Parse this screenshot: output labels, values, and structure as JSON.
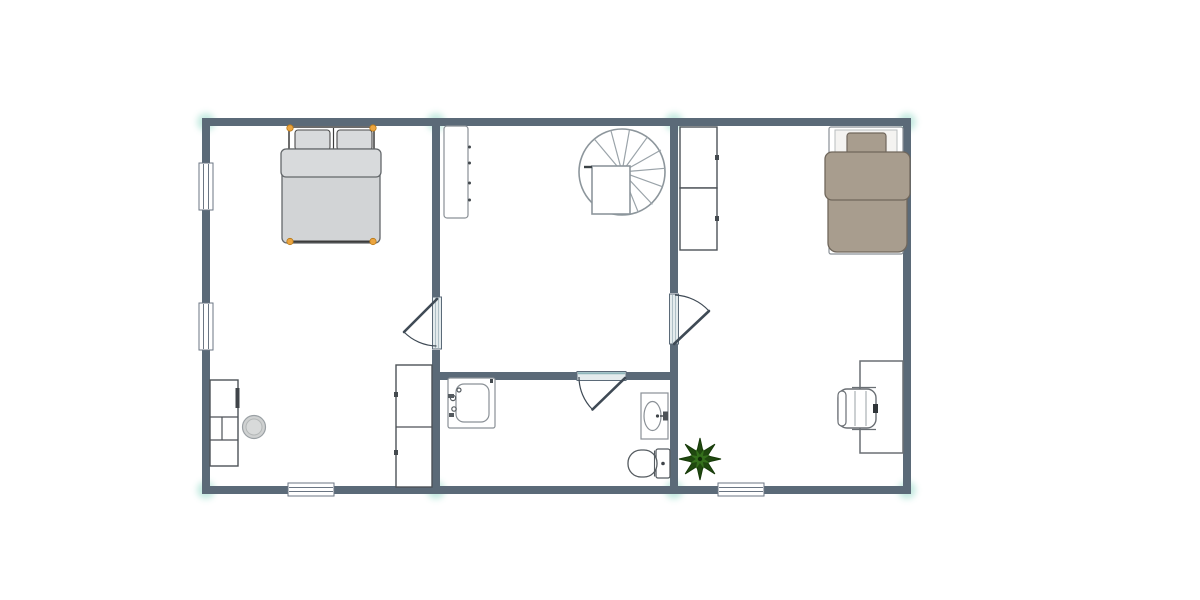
{
  "canvas": {
    "type": "floor-plan-editor-canvas",
    "background": "#ffffff",
    "plan_bounds_px": {
      "left": 202,
      "top": 118,
      "right": 911,
      "bottom": 494
    }
  },
  "colors": {
    "wall": "#5b6a78",
    "snap": "#7fd1bd",
    "outline": "#4d5257",
    "outlineLight": "#8a9096",
    "bedGray": "#d2d4d6",
    "bedGrayFold": "#d8dadc",
    "taupe": "#a89d8e",
    "taupeDark": "#70675c",
    "handle": "#eca53f",
    "handleStroke": "#b77818",
    "plantDark": "#20490f",
    "plantLight": "#35701c",
    "doorLeaf": "#e4ebed",
    "doorTeal": "#8fb6bb",
    "swing": "#3f4a55",
    "stoolFill": "#cfd1d1"
  },
  "floor_plan": {
    "wall_thickness_px": 8,
    "rooms": [
      {
        "name": "bedroom-left",
        "furniture": [
          "double-bed (selected, 4 orange handles)",
          "dresser-with-knob",
          "round-stool",
          "storage-cabinet-2-door"
        ]
      },
      {
        "name": "stair-hall",
        "furniture": [
          "wardrobe-4-hinges",
          "spiral-staircase"
        ]
      },
      {
        "name": "bathroom",
        "furniture": [
          "washbasin-with-taps",
          "vanity-sink-oval",
          "toilet"
        ]
      },
      {
        "name": "bedroom-right",
        "furniture": [
          "single-bed-taupe",
          "shelf-unit-upper",
          "shelf-unit-lower",
          "desk",
          "office-chair",
          "potted-plant"
        ]
      }
    ],
    "doors": [
      {
        "name": "door-left-hall",
        "wall": "between bedroom-left and stair-hall",
        "swing": "into bedroom-left"
      },
      {
        "name": "door-hall-bathroom",
        "wall": "bathroom top wall",
        "swing": "into bathroom"
      },
      {
        "name": "door-hall-right",
        "wall": "between stair-hall and bedroom-right",
        "swing": "into bedroom-right"
      }
    ],
    "windows": [
      {
        "name": "window-left-upper",
        "wall": "left exterior"
      },
      {
        "name": "window-left-lower",
        "wall": "left exterior"
      },
      {
        "name": "window-bottom-left",
        "wall": "bottom exterior"
      },
      {
        "name": "window-bottom-right",
        "wall": "bottom exterior"
      }
    ],
    "snap_markers": {
      "color": "#7fd1bd",
      "positions": "all wall junctions (8)"
    }
  }
}
